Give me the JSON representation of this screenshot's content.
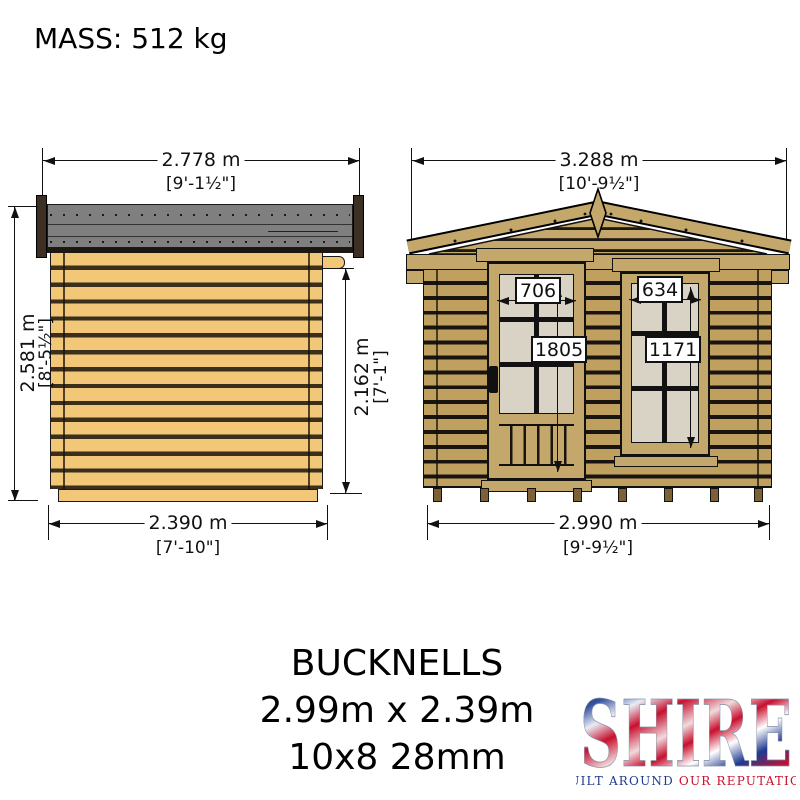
{
  "header": {
    "mass_label": "MASS: 512 kg"
  },
  "side_view": {
    "width_top": {
      "metric": "2.778 m",
      "imperial": "[9'-1½\"]"
    },
    "height_overall": {
      "metric": "2.581 m",
      "imperial": "[8'-5½\"]"
    },
    "height_wall": {
      "metric": "2.162 m",
      "imperial": "[7'-1\"]"
    },
    "width_bottom": {
      "metric": "2.390 m",
      "imperial": "[7'-10\"]"
    }
  },
  "front_view": {
    "width_top": {
      "metric": "3.288 m",
      "imperial": "[10'-9½\"]"
    },
    "width_bottom": {
      "metric": "2.990 m",
      "imperial": "[9'-9½\"]"
    },
    "door": {
      "width_mm": "706",
      "height_mm": "1805"
    },
    "window": {
      "width_mm": "634",
      "height_mm": "1171"
    }
  },
  "footer": {
    "product_name": "BUCKNELLS",
    "dimensions": "2.99m x 2.39m",
    "spec": "10x8 28mm"
  },
  "brand": {
    "name": "SHIRE",
    "tagline_1": "BUILT AROUND ",
    "tagline_2": "OUR REPUTATION"
  },
  "colors": {
    "side_log": "#f2c878",
    "front_log": "#bfa05f",
    "trim_tan": "#c4a76a",
    "roof_gray": "#7f7f7f",
    "bargeboard_dark": "#3b3023",
    "glass": "#d8d3c4",
    "brand_blue": "#1d3a8f",
    "brand_red": "#c8102e"
  }
}
